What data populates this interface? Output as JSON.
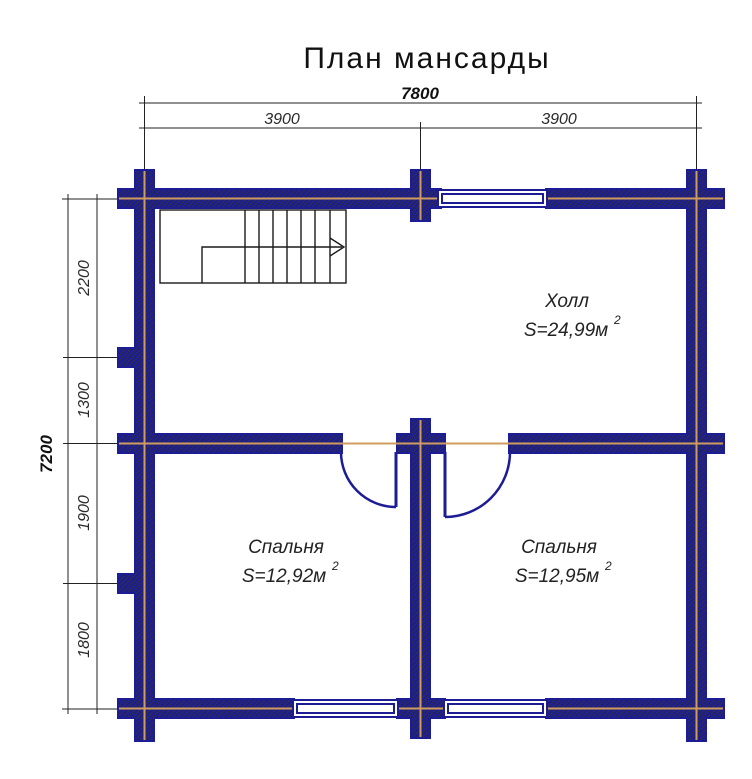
{
  "title": "План мансарды",
  "dimensions": {
    "top": {
      "total": "7800",
      "segments": [
        "3900",
        "3900"
      ]
    },
    "left": {
      "total": "7200",
      "segments": [
        "2200",
        "1300",
        "1900",
        "1800"
      ]
    }
  },
  "rooms": [
    {
      "name": "Холл",
      "area": "S=24,99м",
      "area_sup": "2"
    },
    {
      "name": "Спальня",
      "area": "S=12,92м",
      "area_sup": "2"
    },
    {
      "name": "Спальня",
      "area": "S=12,95м",
      "area_sup": "2"
    }
  ],
  "colors": {
    "wall_outline": "#1c1c94",
    "wall_hatch": "#333333",
    "axis_line": "#cf9c5f",
    "dimension_lines": "#222222",
    "background": "#ffffff"
  }
}
